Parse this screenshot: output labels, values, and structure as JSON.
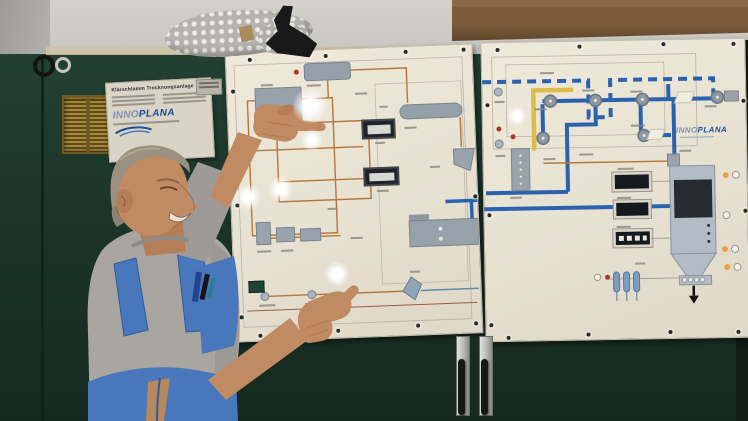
{
  "scene": {
    "type": "photograph",
    "description": "Technician in blue bib overalls pointing at the process mimic panels of a sewage-sludge drying plant mounted on dark-green control cabinets, with a cardboard box and bubble wrap on top"
  },
  "nameplate": {
    "title": "Klärschlamm Trocknungsanlage",
    "brand_light": "INNO",
    "brand_bold": "PLANA"
  },
  "mimic_panel": {
    "brand_light": "INNO",
    "brand_bold": "PLANA"
  },
  "colors": {
    "cabinet_green": "#1c352a",
    "panel_cream": "#e7e1d2",
    "diagram_orange": "#b5763a",
    "duct_blue": "#2b62ae",
    "duct_yellow": "#dcbd45",
    "brand_blue": "#1d4f93",
    "overalls_blue": "#4877bb",
    "shirt_gray": "#a9a6a2",
    "skin": "#c08a63",
    "cardboard_brown": "#7c5c3a",
    "wall_gray": "#c9c7c2"
  }
}
